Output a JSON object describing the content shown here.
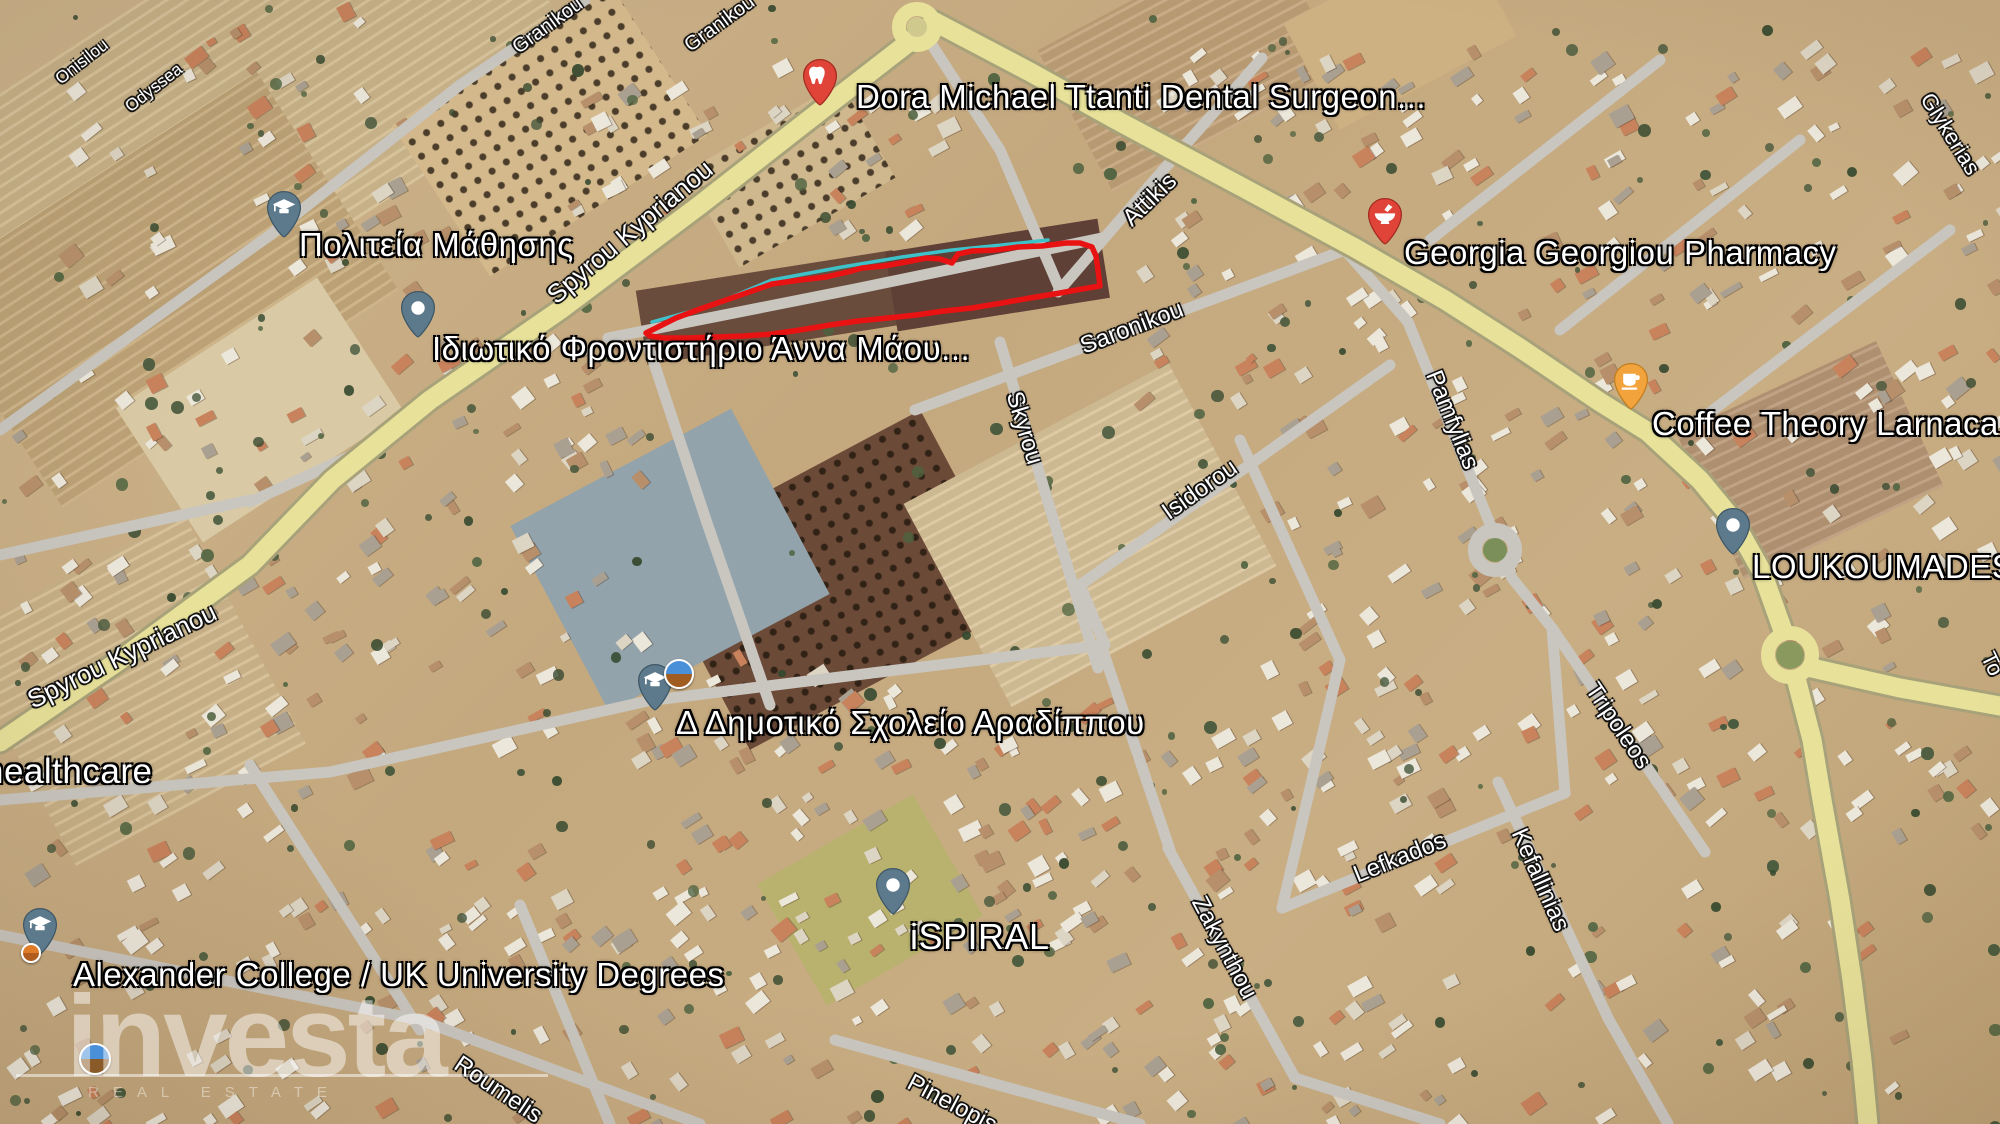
{
  "canvas": {
    "width": 2000,
    "height": 1124
  },
  "watermark": {
    "brand": "investa",
    "tagline": "REAL ESTATE"
  },
  "parcel": {
    "color": "#e91212",
    "points": "646,333 660,326 676,318 700,309 726,300 752,291 772,284 800,280 826,277 848,272 862,268 884,266 906,262 926,258 940,259 952,263 958,254 972,251 996,250 1018,247 1042,246 1066,243 1080,243 1092,247 1096,256 1098,270 1100,286 1082,289 1060,293 1030,298 1002,303 972,308 944,311 916,315 888,318 858,321 830,325 800,330 772,334 744,336 716,337 688,338 664,338 650,336 646,333"
  },
  "utility_line": {
    "color": "#3fc1c9",
    "points": "652,322 710,306 772,280 842,267 902,257 952,250 1002,245 1048,240"
  },
  "roads": {
    "highway_fill": "#e7e19a",
    "highway_casing": "#a8a27a",
    "street_color": "#c9c6c0",
    "highways": [
      "935,22 806,122 700,205 560,310 430,400 332,480 250,565 120,660 0,742",
      "935,22 1030,72 1120,122 1240,186 1355,248 1445,300 1520,348 1600,402 1648,432 1700,480 1733,520 1762,572 1782,628",
      "1797,682 1812,740 1822,800 1840,900 1852,980 1862,1060 1868,1124",
      "1812,668 1900,688 2000,706"
    ],
    "streets": [
      "1058,292 1150,185 1262,58",
      "915,410 1345,250",
      "1080,585 1390,365",
      "1282,908 1565,793",
      "420,1020 700,1124",
      "835,1040 1140,1124",
      "1000,342 1098,668",
      "1408,322 1512,578",
      "1552,628 1705,852",
      "1498,782 1608,1018",
      "1168,848 1295,1078",
      "608,338 860,288 1102,238",
      "648,345 706,520 770,705",
      "655,700 880,672 1105,645",
      "1102,648 1170,850",
      "1345,250 1408,322",
      "1430,240 1660,60",
      "1560,330 1800,140",
      "1700,420 1950,230",
      "0,935 420,1020",
      "250,765 420,1030",
      "520,905 610,1124",
      "0,430 270,235 460,85 585,0",
      "652,700 330,772 0,800",
      "1295,1078 1440,1124",
      "1608,1018 1668,1124",
      "930,42 1000,150 1060,290",
      "1512,578 1552,628",
      "1565,793 1552,628",
      "1240,440 1340,660",
      "1340,660 1282,908",
      "0,555 250,500",
      "250,502 372,446 430,400",
      "1105,645 1080,585"
    ]
  },
  "roundabouts": [
    {
      "x": 917,
      "y": 27,
      "r": 18,
      "ring": "#e7e19a",
      "center": "#cfc98e"
    },
    {
      "x": 1495,
      "y": 550,
      "r": 20,
      "ring": "#c9c6c0",
      "center": "#7b8f5a"
    },
    {
      "x": 1790,
      "y": 655,
      "r": 22,
      "ring": "#e7e19a",
      "center": "#8a9a5e"
    }
  ],
  "street_labels": [
    {
      "text": "Spyrou Kyprianou",
      "x": 630,
      "y": 232,
      "rot": -40,
      "size": 26
    },
    {
      "text": "Spyrou Kyprianou",
      "x": 122,
      "y": 656,
      "rot": -26,
      "size": 26
    },
    {
      "text": "Attikis",
      "x": 1150,
      "y": 200,
      "rot": -44,
      "size": 24
    },
    {
      "text": "Saronikou",
      "x": 1132,
      "y": 328,
      "rot": -21,
      "size": 24
    },
    {
      "text": "Skyrou",
      "x": 1024,
      "y": 428,
      "rot": 73,
      "size": 24
    },
    {
      "text": "Isidorou",
      "x": 1200,
      "y": 490,
      "rot": -35,
      "size": 24
    },
    {
      "text": "Pamfylias",
      "x": 1452,
      "y": 420,
      "rot": 68,
      "size": 24
    },
    {
      "text": "Tripoleos",
      "x": 1618,
      "y": 726,
      "rot": 56,
      "size": 24
    },
    {
      "text": "Lefkados",
      "x": 1400,
      "y": 858,
      "rot": -22,
      "size": 24
    },
    {
      "text": "Kefallinias",
      "x": 1540,
      "y": 880,
      "rot": 66,
      "size": 24
    },
    {
      "text": "Zakynthou",
      "x": 1224,
      "y": 948,
      "rot": 62,
      "size": 24
    },
    {
      "text": "Roumelis",
      "x": 498,
      "y": 1090,
      "rot": 34,
      "size": 24
    },
    {
      "text": "Pinelopis",
      "x": 952,
      "y": 1104,
      "rot": 28,
      "size": 24
    },
    {
      "text": "Granikou",
      "x": 548,
      "y": 26,
      "rot": -36,
      "size": 20
    },
    {
      "text": "Granikou",
      "x": 720,
      "y": 24,
      "rot": -36,
      "size": 20
    },
    {
      "text": "Onisilou",
      "x": 82,
      "y": 62,
      "rot": -38,
      "size": 17
    },
    {
      "text": "Odyssea",
      "x": 154,
      "y": 88,
      "rot": -38,
      "size": 17
    },
    {
      "text": "Glykerias",
      "x": 1950,
      "y": 134,
      "rot": 58,
      "size": 22
    },
    {
      "text": "To",
      "x": 1992,
      "y": 664,
      "rot": 64,
      "size": 22
    }
  ],
  "places": [
    {
      "id": "dental-surgeon",
      "label": "Dora Michael Ttanti Dental Surgeon...",
      "size": 33,
      "pin": {
        "x": 820,
        "y": 108,
        "color": "#e04438",
        "stroke": "#a32a20",
        "glyph": "tooth"
      },
      "label_pos": {
        "x": 856,
        "y": 78
      }
    },
    {
      "id": "politeia-mathisis",
      "label": "Πολιτεία Μάθησης",
      "size": 33,
      "pin": {
        "x": 284,
        "y": 240,
        "color": "#5d7a8c",
        "stroke": "#3e5766",
        "glyph": "grad"
      },
      "label_pos": {
        "x": 299,
        "y": 226
      }
    },
    {
      "id": "idiotiko-frontistirio",
      "label": "Ιδιωτικό Φροντιστήριο Άννα Μάου...",
      "size": 33,
      "pin": {
        "x": 418,
        "y": 340,
        "color": "#5d7a8c",
        "stroke": "#3e5766",
        "glyph": "dot"
      },
      "label_pos": {
        "x": 432,
        "y": 330
      }
    },
    {
      "id": "georgia-georgiou-pharmacy",
      "label": "Georgia Georgiou Pharmacy",
      "size": 33,
      "pin": {
        "x": 1385,
        "y": 247,
        "color": "#e04438",
        "stroke": "#a32a20",
        "glyph": "mortar"
      },
      "label_pos": {
        "x": 1404,
        "y": 234
      }
    },
    {
      "id": "coffee-theory-larnaca",
      "label": "Coffee Theory Larnaca",
      "size": 33,
      "pin": {
        "x": 1631,
        "y": 412,
        "color": "#f2a33c",
        "stroke": "#c07d1f",
        "glyph": "cup"
      },
      "label_pos": {
        "x": 1652,
        "y": 405
      }
    },
    {
      "id": "loukoumades",
      "label": "LOUKOUMADES",
      "size": 33,
      "pin": {
        "x": 1733,
        "y": 557,
        "color": "#5d7a8c",
        "stroke": "#3e5766",
        "glyph": "dot"
      },
      "label_pos": {
        "x": 1752,
        "y": 548
      }
    },
    {
      "id": "dimotiko-scholeio-aradippou",
      "label": "Δ Δημοτικό Σχολείο Αραδίππου",
      "size": 33,
      "pin": {
        "x": 655,
        "y": 713,
        "color": "#5d7a8c",
        "stroke": "#3e5766",
        "glyph": "grad"
      },
      "label_pos": {
        "x": 676,
        "y": 704
      }
    },
    {
      "id": "ispiral",
      "label": "iSPIRAL",
      "size": 36,
      "pin": {
        "x": 893,
        "y": 917,
        "color": "#5d7a8c",
        "stroke": "#3e5766",
        "glyph": "dot"
      },
      "label_pos": {
        "x": 910,
        "y": 916
      }
    },
    {
      "id": "alexander-college",
      "label": "Alexander College / UK University Degrees",
      "size": 33,
      "pin": {
        "x": 40,
        "y": 957,
        "color": "#5d7a8c",
        "stroke": "#3e5766",
        "glyph": "grad"
      },
      "label_pos": {
        "x": 73,
        "y": 956
      }
    },
    {
      "id": "healthcare",
      "label": "healthcare",
      "size": 35,
      "pin": null,
      "label_pos": {
        "x": -16,
        "y": 752
      }
    }
  ],
  "extra_icons": [
    {
      "id": "school-logo",
      "x": 664,
      "y": 659,
      "d": 26,
      "top": "#4a90d9",
      "bottom": "#a15c22"
    },
    {
      "id": "college-dot",
      "x": 21,
      "y": 943,
      "d": 16,
      "top": "#e07b28",
      "bottom": "#b05c1e"
    },
    {
      "id": "corner-logo",
      "x": 79,
      "y": 1043,
      "d": 28,
      "top": "#4a90d9",
      "bottom": "#8a5a28"
    }
  ],
  "terrain": {
    "fields": [
      {
        "x": -60,
        "y": -40,
        "w": 620,
        "h": 300,
        "rot": -33,
        "c": "#d3bc90",
        "rows": true
      },
      {
        "x": -40,
        "y": 160,
        "w": 400,
        "h": 260,
        "rot": -33,
        "c": "#c7ab7c",
        "rows": true
      },
      {
        "x": 140,
        "y": 330,
        "w": 240,
        "h": 160,
        "rot": -33,
        "c": "#d9c9a4",
        "rows": false
      },
      {
        "x": 0,
        "y": 560,
        "w": 260,
        "h": 260,
        "rot": -28,
        "c": "#d2ba8e",
        "rows": true
      },
      {
        "x": 420,
        "y": 40,
        "w": 260,
        "h": 180,
        "rot": -33,
        "c": "#d3b98c",
        "rows": false,
        "dots": true
      },
      {
        "x": 700,
        "y": 120,
        "w": 180,
        "h": 110,
        "rot": -30,
        "c": "#d0b88e",
        "rows": false,
        "dots": true
      },
      {
        "x": 640,
        "y": 270,
        "w": 260,
        "h": 75,
        "rot": -9,
        "c": "#6a4c3c",
        "rows": false
      },
      {
        "x": 890,
        "y": 235,
        "w": 215,
        "h": 80,
        "rot": -9,
        "c": "#5e4036",
        "rows": false
      },
      {
        "x": 680,
        "y": 470,
        "w": 310,
        "h": 220,
        "rot": -28,
        "c": "#6b4a38",
        "rows": false,
        "dots": true
      },
      {
        "x": 940,
        "y": 420,
        "w": 300,
        "h": 230,
        "rot": -28,
        "c": "#d9c39a",
        "rows": true
      },
      {
        "x": 1060,
        "y": -20,
        "w": 260,
        "h": 160,
        "rot": -28,
        "c": "#c2a379",
        "rows": true
      },
      {
        "x": 1300,
        "y": -30,
        "w": 200,
        "h": 120,
        "rot": -28,
        "c": "#cdb183",
        "rows": false
      },
      {
        "x": 1700,
        "y": 380,
        "w": 220,
        "h": 160,
        "rot": -25,
        "c": "#b99877",
        "rows": true
      },
      {
        "x": 780,
        "y": 830,
        "w": 180,
        "h": 140,
        "rot": -30,
        "c": "#b9b26e",
        "rows": false
      },
      {
        "x": 545,
        "y": 455,
        "w": 250,
        "h": 210,
        "rot": -28,
        "c": "#93a3ab",
        "rows": false
      }
    ],
    "building_zones": [
      {
        "x": 0,
        "y": 330,
        "w": 430,
        "h": 460,
        "n": 90
      },
      {
        "x": 420,
        "y": 620,
        "w": 500,
        "h": 330,
        "n": 80
      },
      {
        "x": 60,
        "y": 0,
        "w": 380,
        "h": 300,
        "n": 45
      },
      {
        "x": 1120,
        "y": 40,
        "w": 880,
        "h": 360,
        "n": 150
      },
      {
        "x": 1240,
        "y": 400,
        "w": 760,
        "h": 430,
        "n": 150
      },
      {
        "x": 260,
        "y": 880,
        "w": 1640,
        "h": 244,
        "n": 150
      },
      {
        "x": 0,
        "y": 760,
        "w": 280,
        "h": 364,
        "n": 45
      },
      {
        "x": 560,
        "y": 60,
        "w": 380,
        "h": 170,
        "n": 40
      },
      {
        "x": 430,
        "y": 330,
        "w": 220,
        "h": 300,
        "n": 40
      },
      {
        "x": 940,
        "y": 700,
        "w": 500,
        "h": 180,
        "n": 60
      }
    ],
    "building_palette": [
      "#ece7db",
      "#ece7db",
      "#ddd5c4",
      "#c8825c",
      "#b7906b",
      "#a9a092"
    ],
    "tree_palette": [
      "#42553a",
      "#36492f",
      "#4e6340"
    ],
    "tree_count": 300
  }
}
